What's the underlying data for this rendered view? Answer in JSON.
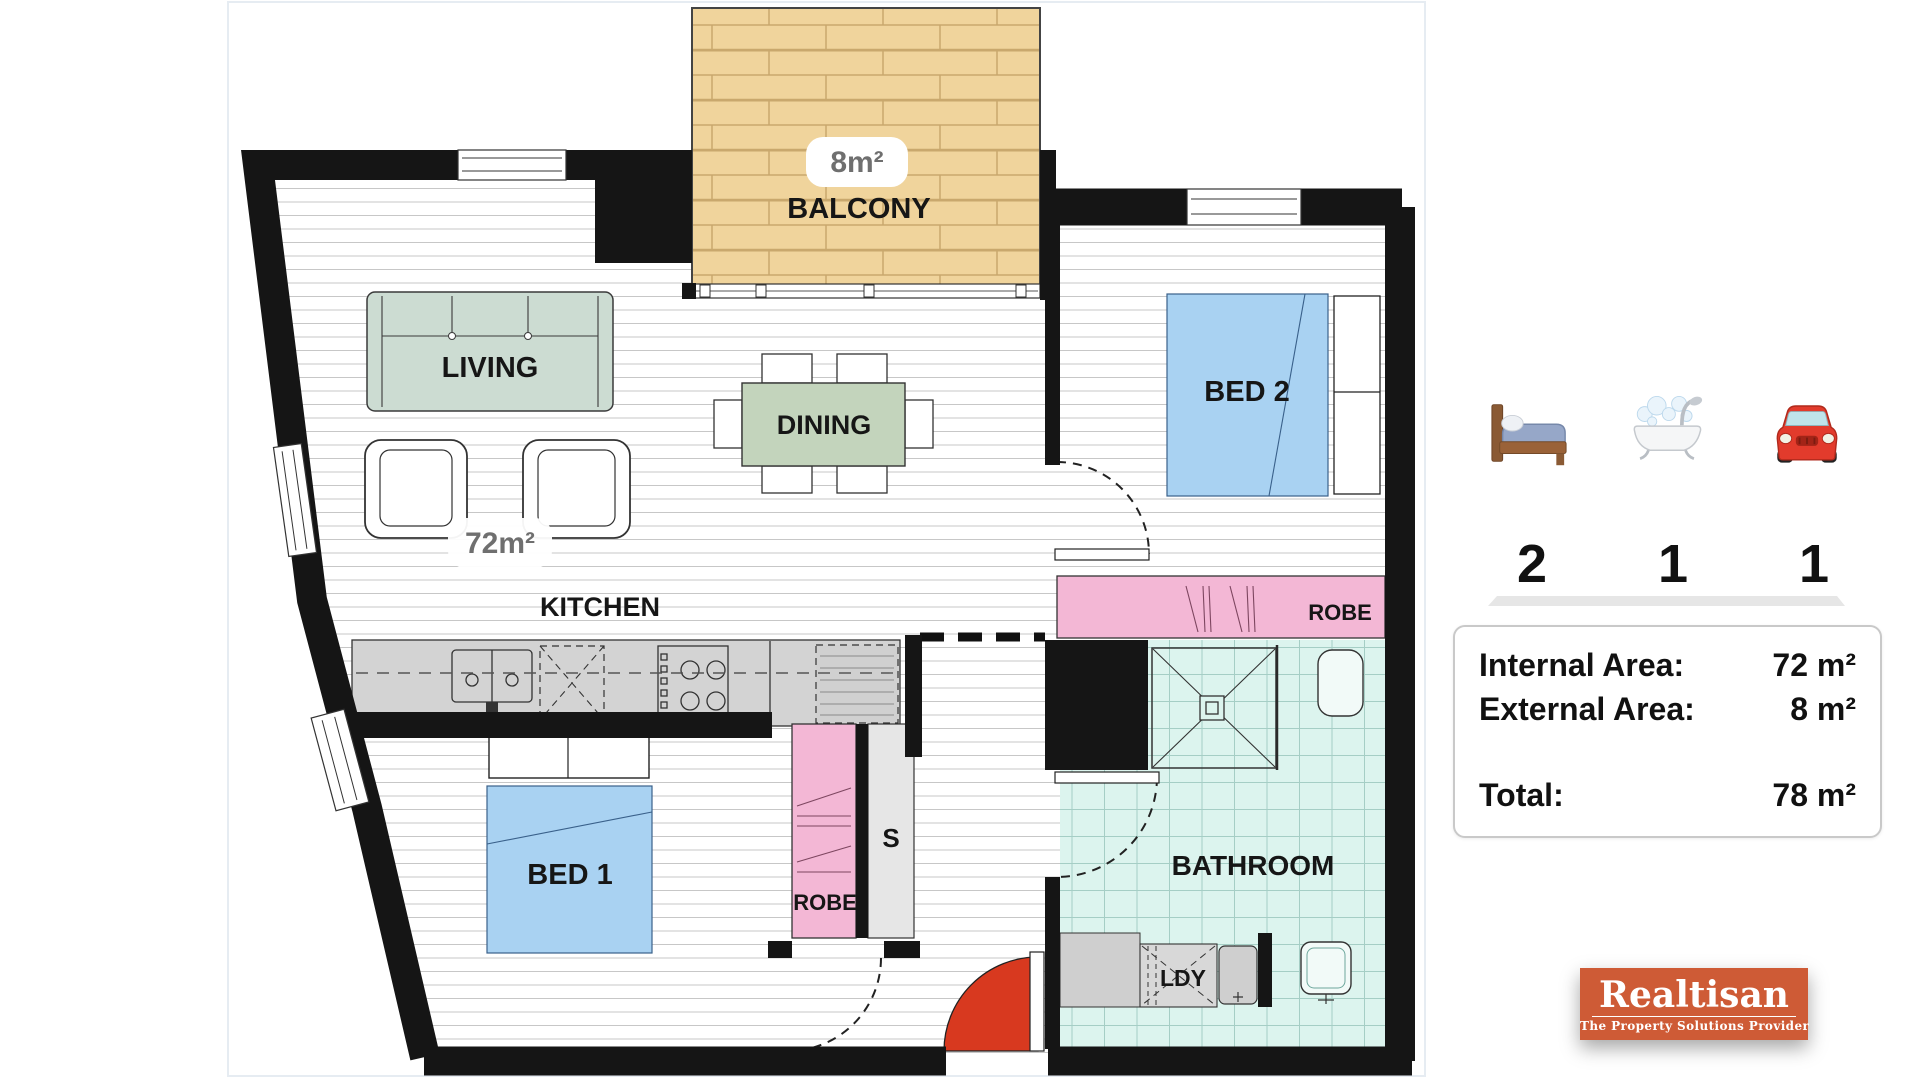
{
  "plan": {
    "labels": {
      "living": "LIVING",
      "balcony": "BALCONY",
      "balcony_area": "8m²",
      "internal_area": "72m²",
      "dining": "DINING",
      "kitchen": "KITCHEN",
      "bed1": "BED 1",
      "bed2": "BED 2",
      "robe1": "ROBE",
      "robe2": "ROBE",
      "storage": "S",
      "bathroom": "BATHROOM",
      "laundry": "LDY"
    }
  },
  "summary": {
    "bedrooms": "2",
    "bathrooms": "1",
    "carspaces": "1",
    "icons": [
      "bed-icon",
      "bath-icon",
      "car-icon"
    ]
  },
  "areas": {
    "internal_label": "Internal Area:",
    "internal_value": "72 m²",
    "external_label": "External Area:",
    "external_value": "8 m²",
    "total_label": "Total:",
    "total_value": "78 m²"
  },
  "logo": {
    "name": "Realtisan",
    "tagline": "The Property Solutions Provider"
  },
  "theme": {
    "wall": "#151515",
    "floor_line": "#c7c7c7",
    "balcony_fill": "#f0d49c",
    "balcony_line": "#c9a86d",
    "bed_fill": "#a9d2f2",
    "bed_line": "#3a628c",
    "sofa_fill": "#ccdcd2",
    "dining_fill": "#c3d4bc",
    "robe_fill": "#f3b7d5",
    "closet_fill": "#e6e6e6",
    "counter_fill": "#d3d3d3",
    "bath_fill": "#dcf4ee",
    "bath_line": "#a5cec5",
    "door_red": "#d8391f",
    "label": "#161616",
    "area_label": "#6f6f6f",
    "logo_bg": "#ce5b36",
    "divider": "#e6e6e6"
  }
}
